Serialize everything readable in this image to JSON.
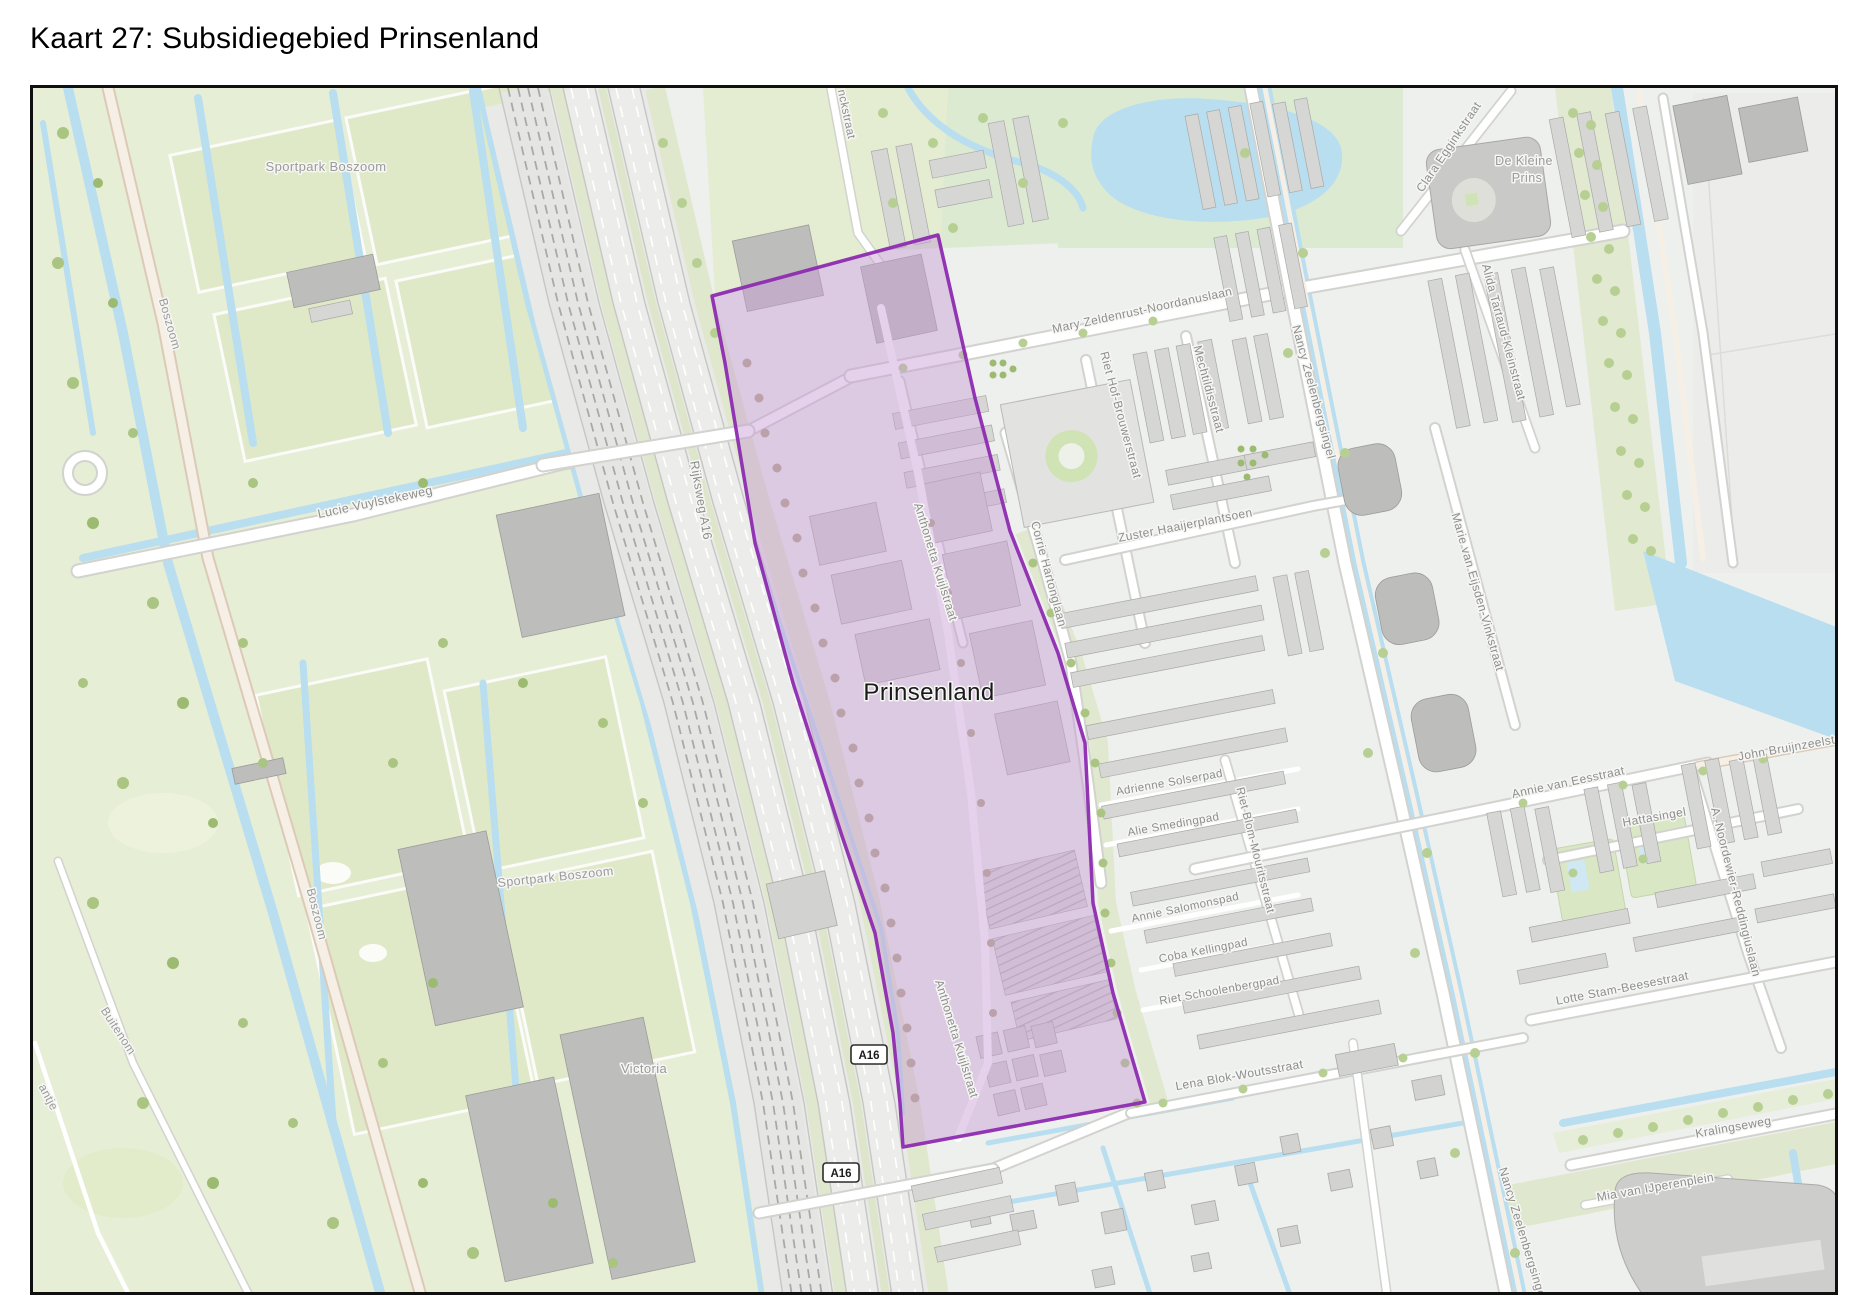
{
  "title": "Kaart 27: Subsidiegebied Prinsenland",
  "map": {
    "highlighted_area_name": "Prinsenland",
    "labels": [
      {
        "name": "area-label-sportpark-boszoom-north",
        "text": "Sportpark Boszoom",
        "x": 323,
        "y": 168,
        "r": 0,
        "size": 13,
        "color": "#9a9a98"
      },
      {
        "name": "road-label-boszoom-north",
        "text": "Boszoom",
        "x": 163,
        "y": 322,
        "r": 74,
        "size": 12,
        "color": "#9a9a98"
      },
      {
        "name": "road-label-boszoom-south",
        "text": "Boszoom",
        "x": 310,
        "y": 912,
        "r": 76,
        "size": 12,
        "color": "#9a9a98"
      },
      {
        "name": "road-label-buitenom",
        "text": "Buitenom",
        "x": 112,
        "y": 1030,
        "r": 57,
        "size": 12,
        "color": "#9a9a98"
      },
      {
        "name": "road-label-partial-antje",
        "text": "antje",
        "x": 42,
        "y": 1096,
        "r": 62,
        "size": 12,
        "color": "#9a9a98"
      },
      {
        "name": "road-label-lucie-vuylstekeweg",
        "text": "Lucie Vuylstekeweg",
        "x": 373,
        "y": 503,
        "r": -12,
        "size": 12.5,
        "color": "#8e8e8c"
      },
      {
        "name": "road-label-rijksweg-a16",
        "text": "Rijksweg A16",
        "x": 694,
        "y": 498,
        "r": 80,
        "size": 12.5,
        "color": "#8e8e8c"
      },
      {
        "name": "area-label-victoria",
        "text": "Victoria",
        "x": 641,
        "y": 1070,
        "r": 0,
        "size": 13,
        "color": "#9a9a98"
      },
      {
        "name": "area-label-sportpark-boszoom-south",
        "text": "Sportpark Boszoom",
        "x": 553,
        "y": 878,
        "r": -6,
        "size": 12.5,
        "color": "#9a9a98"
      },
      {
        "name": "area-label-prinsenland",
        "text": "Prinsenland",
        "x": 926,
        "y": 697,
        "r": 0,
        "size": 24,
        "color": "#1a1a1a"
      },
      {
        "name": "road-label-anthonetta-kuijlstraat-north",
        "text": "Anthonetta Kuijlstraat",
        "x": 929,
        "y": 560,
        "r": 73,
        "size": 12,
        "color": "#8e8e8c"
      },
      {
        "name": "road-label-anthonetta-kuijlstraat-south",
        "text": "Anthonetta Kuijlstraat",
        "x": 950,
        "y": 1037,
        "r": 73,
        "size": 12,
        "color": "#8e8e8c"
      },
      {
        "name": "road-label-mary-zeldenrust-noordanuslaan",
        "text": "Mary Zeldenrust-Noordanuslaan",
        "x": 1140,
        "y": 311,
        "r": -12,
        "size": 12,
        "color": "#8e8e8c"
      },
      {
        "name": "road-label-riet-hof-brouwerstraat",
        "text": "Riet Hof-Brouwerstraat",
        "x": 1114,
        "y": 413,
        "r": 75,
        "size": 12,
        "color": "#8e8e8c"
      },
      {
        "name": "road-label-mechtildisstraat",
        "text": "Mechtildisstraat",
        "x": 1202,
        "y": 387,
        "r": 75,
        "size": 12,
        "color": "#8e8e8c"
      },
      {
        "name": "road-label-nancy-zeelenbergsingel-north",
        "text": "Nancy Zeelenbergsingel",
        "x": 1307,
        "y": 390,
        "r": 75,
        "size": 12,
        "color": "#8e8e8c"
      },
      {
        "name": "road-label-corrie-hartonglaan",
        "text": "Corrie Hartonglaan",
        "x": 1042,
        "y": 572,
        "r": 75,
        "size": 12,
        "color": "#8e8e8c"
      },
      {
        "name": "road-label-zuster-haaijerplantsoen",
        "text": "Zuster Haaijerplantsoen",
        "x": 1183,
        "y": 526,
        "r": -11,
        "size": 12,
        "color": "#8e8e8c"
      },
      {
        "name": "road-label-clara-egginkstraat",
        "text": "Clara Egginkstraat",
        "x": 1449,
        "y": 146,
        "r": -56,
        "size": 12,
        "color": "#8e8e8c"
      },
      {
        "name": "area-label-de-kleine-prins-line1",
        "text": "De Kleine",
        "x": 1521,
        "y": 162,
        "r": 0,
        "size": 12.5,
        "color": "#9a9a98"
      },
      {
        "name": "area-label-de-kleine-prins-line2",
        "text": "Prins",
        "x": 1524,
        "y": 179,
        "r": 0,
        "size": 12.5,
        "color": "#9a9a98"
      },
      {
        "name": "road-label-alida-tartaud-kleinstraat",
        "text": "Alida Tartaud-Kleinstraat",
        "x": 1497,
        "y": 330,
        "r": 75,
        "size": 12,
        "color": "#8e8e8c"
      },
      {
        "name": "road-label-marie-van-eijsden-vinkstraat",
        "text": "Marie van Eijsden-Vinkstraat",
        "x": 1471,
        "y": 590,
        "r": 74,
        "size": 12,
        "color": "#8e8e8c"
      },
      {
        "name": "road-label-adrienne-solserpad",
        "text": "Adrienne Solserpad",
        "x": 1167,
        "y": 783,
        "r": -10,
        "size": 11.5,
        "color": "#8e8e8c"
      },
      {
        "name": "road-label-alie-smedingpad",
        "text": "Alie Smedingpad",
        "x": 1171,
        "y": 825,
        "r": -10,
        "size": 11.5,
        "color": "#8e8e8c"
      },
      {
        "name": "road-label-riet-blom-mouritsstraat",
        "text": "Riet Blom-Mouritsstraat",
        "x": 1249,
        "y": 848,
        "r": 76,
        "size": 11.5,
        "color": "#8e8e8c"
      },
      {
        "name": "road-label-annie-salomonspad",
        "text": "Annie Salomonspad",
        "x": 1183,
        "y": 908,
        "r": -12,
        "size": 11.5,
        "color": "#8e8e8c"
      },
      {
        "name": "road-label-coba-kellingpad",
        "text": "Coba Kellingpad",
        "x": 1201,
        "y": 951,
        "r": -11,
        "size": 11.5,
        "color": "#8e8e8c"
      },
      {
        "name": "road-label-riet-schoolenbergpad",
        "text": "Riet Schoolenbergpad",
        "x": 1217,
        "y": 991,
        "r": -10,
        "size": 11.5,
        "color": "#8e8e8c"
      },
      {
        "name": "road-label-lena-blok-woutsstraat",
        "text": "Lena Blok-Woutsstraat",
        "x": 1237,
        "y": 1076,
        "r": -10,
        "size": 12,
        "color": "#8e8e8c"
      },
      {
        "name": "road-label-annie-van-eesstraat",
        "text": "Annie van Eesstraat",
        "x": 1566,
        "y": 783,
        "r": -12,
        "size": 12,
        "color": "#8e8e8c"
      },
      {
        "name": "road-label-hattasingel",
        "text": "Hattasingel",
        "x": 1652,
        "y": 818,
        "r": -10,
        "size": 12,
        "color": "#8e8e8c"
      },
      {
        "name": "road-label-john-bruijnzeelstraat",
        "text": "John Bruijnzeelstraat",
        "x": 1795,
        "y": 747,
        "r": -10,
        "size": 12,
        "color": "#8e8e8c"
      },
      {
        "name": "road-label-a-noordewier-reddingiuslaan",
        "text": "A. Noordewier-Reddingiuslaan",
        "x": 1729,
        "y": 890,
        "r": 76,
        "size": 12,
        "color": "#8e8e8c"
      },
      {
        "name": "road-label-lotte-stam-beesestraat",
        "text": "Lotte Stam-Beesestraat",
        "x": 1620,
        "y": 989,
        "r": -11,
        "size": 12,
        "color": "#8e8e8c"
      },
      {
        "name": "road-label-kralingseweg",
        "text": "Kralingseweg",
        "x": 1731,
        "y": 1128,
        "r": -10,
        "size": 12,
        "color": "#8e8e8c"
      },
      {
        "name": "road-label-mia-van-ijperenplein",
        "text": "Mia van IJperenplein",
        "x": 1653,
        "y": 1188,
        "r": -10,
        "size": 12,
        "color": "#8e8e8c"
      },
      {
        "name": "road-label-nancy-zeelenbergsingel-south",
        "text": "Nancy Zeelenbergsingel",
        "x": 1516,
        "y": 1232,
        "r": 73,
        "size": 12,
        "color": "#8e8e8c"
      },
      {
        "name": "road-label-partial-nckstraat",
        "text": "nckstraat",
        "x": 840,
        "y": 112,
        "r": 78,
        "size": 11.5,
        "color": "#8e8e8c"
      }
    ],
    "road_shields": [
      {
        "name": "a16-shield-upper",
        "text": "A16",
        "x": 866,
        "y": 1052
      },
      {
        "name": "a16-shield-lower",
        "text": "A16",
        "x": 838,
        "y": 1170
      }
    ]
  },
  "colors": {
    "page_bg": "#ffffff",
    "title_color": "#000000",
    "urban": "#eef0ee",
    "grass": "#e7eed6",
    "field": "#dfe9c8",
    "park_green": "#dcead2",
    "water": "#b8def0",
    "road_casing": "#d2d2cf",
    "road_fill": "#ffffff",
    "building": "#d2d2d0",
    "rail_bed": "#e5e5e3",
    "label_color": "#8e8e8c",
    "subsidy_fill": "#c99fd6",
    "subsidy_border": "#8d2bb0"
  }
}
